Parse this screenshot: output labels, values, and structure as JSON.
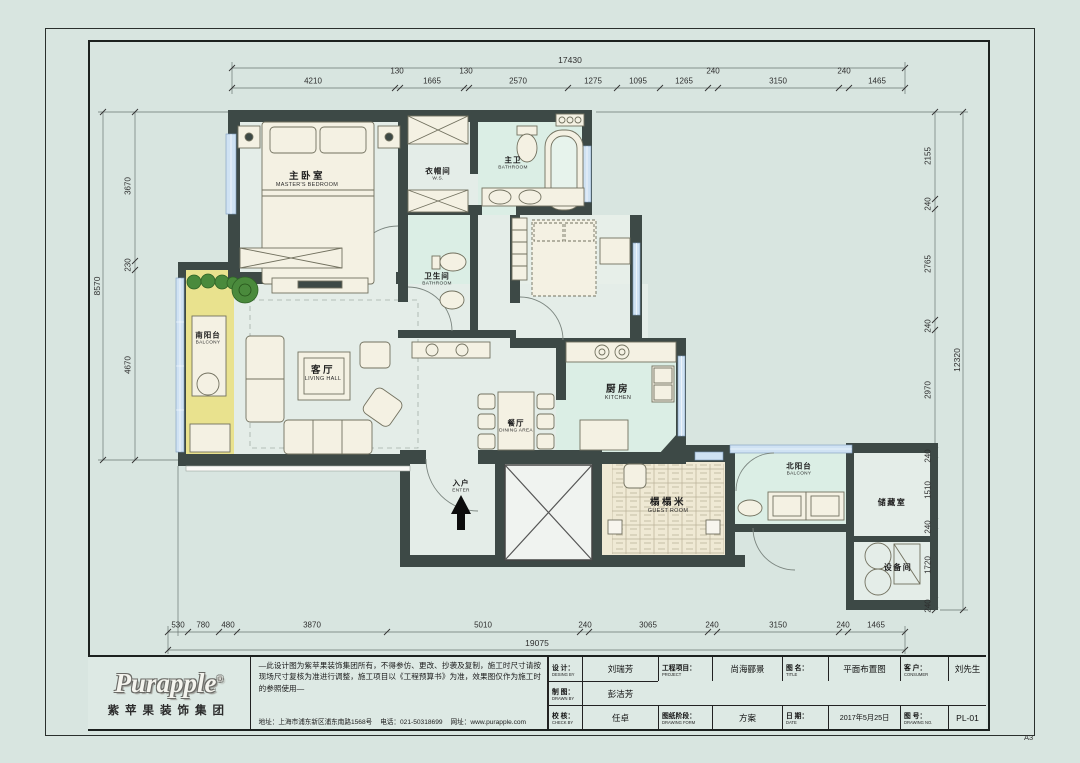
{
  "sheet": {
    "size_label": "A3"
  },
  "rooms": {
    "master_bedroom": {
      "cn": "主卧室",
      "en": "MASTER'S BEDROOM"
    },
    "cloakroom": {
      "cn": "衣帽间",
      "en": "W.S."
    },
    "master_bath": {
      "cn": "主卫",
      "en": "BATHROOM"
    },
    "bathroom": {
      "cn": "卫生间",
      "en": "BATHROOM"
    },
    "living": {
      "cn": "客厅",
      "en": "LIVING HALL"
    },
    "dining": {
      "cn": "餐厅",
      "en": "DINING AREA"
    },
    "kitchen": {
      "cn": "厨房",
      "en": "KITCHEN"
    },
    "south_balcony": {
      "cn": "南阳台",
      "en": "BALCONY"
    },
    "north_balcony": {
      "cn": "北阳台",
      "en": "BALCONY"
    },
    "tatami": {
      "cn": "榻榻米",
      "en": "GUEST ROOM"
    },
    "storage": {
      "cn": "储藏室",
      "en": ""
    },
    "equipment": {
      "cn": "设备间",
      "en": ""
    },
    "entry": {
      "cn": "入户",
      "en": "ENTER"
    }
  },
  "dims": {
    "top_total": "17430",
    "top": [
      "4210",
      "130",
      "1665",
      "130",
      "2570",
      "1275",
      "1095",
      "1265",
      "240",
      "3150",
      "240",
      "1465"
    ],
    "left_total": "8570",
    "left": [
      "3670",
      "230",
      "4670"
    ],
    "right_total": "12320",
    "right": [
      "2155",
      "240",
      "2765",
      "240",
      "2970",
      "240",
      "1510",
      "240",
      "1720",
      "240"
    ],
    "bottom_total": "19075",
    "bottom": [
      "530",
      "780",
      "480",
      "3870",
      "5010",
      "240",
      "3065",
      "240",
      "3150",
      "240",
      "1465"
    ]
  },
  "titleblock": {
    "logo_text": "Purapple",
    "logo_reg": "®",
    "logo_sub": "紫苹果装饰集团",
    "disclaimer": "—此设计图为紫苹果装饰集团所有，不得参仿、更改、抄袭及复制，施工时尺寸请按现场尺寸复核为准进行调整，施工项目以《工程预算书》为准，效果图仅作为施工时的参照使用—",
    "address": "地址：上海市浦东新区浦东南路1568号",
    "phone": "电话：021-50318699",
    "website": "网址：www.purapple.com",
    "fields": {
      "design_label": "设 计：",
      "design_label_en": "DESING BY",
      "design_value": "刘瑞芳",
      "drawn_label": "制 图：",
      "drawn_label_en": "DRAWN BY",
      "drawn_value": "彭洁芳",
      "check_label": "校 核：",
      "check_label_en": "CHECK BY",
      "check_value": "任卓",
      "project_label": "工程项目：",
      "project_label_en": "PROJECT",
      "project_value": "尚海郦景",
      "stage_label": "图纸阶段：",
      "stage_label_en": "DRAWING FORM",
      "stage_value": "方案",
      "title_label": "图 名：",
      "title_label_en": "TITLE",
      "title_value": "平面布置图",
      "date_label": "日 期：",
      "date_label_en": "DATE",
      "date_value": "2017年5月25日",
      "customer_label": "客 户：",
      "customer_label_en": "CONSUMER",
      "customer_value": "刘先生",
      "no_label": "图 号：",
      "no_label_en": "DRAWING NO.",
      "no_value": "PL-01"
    }
  }
}
